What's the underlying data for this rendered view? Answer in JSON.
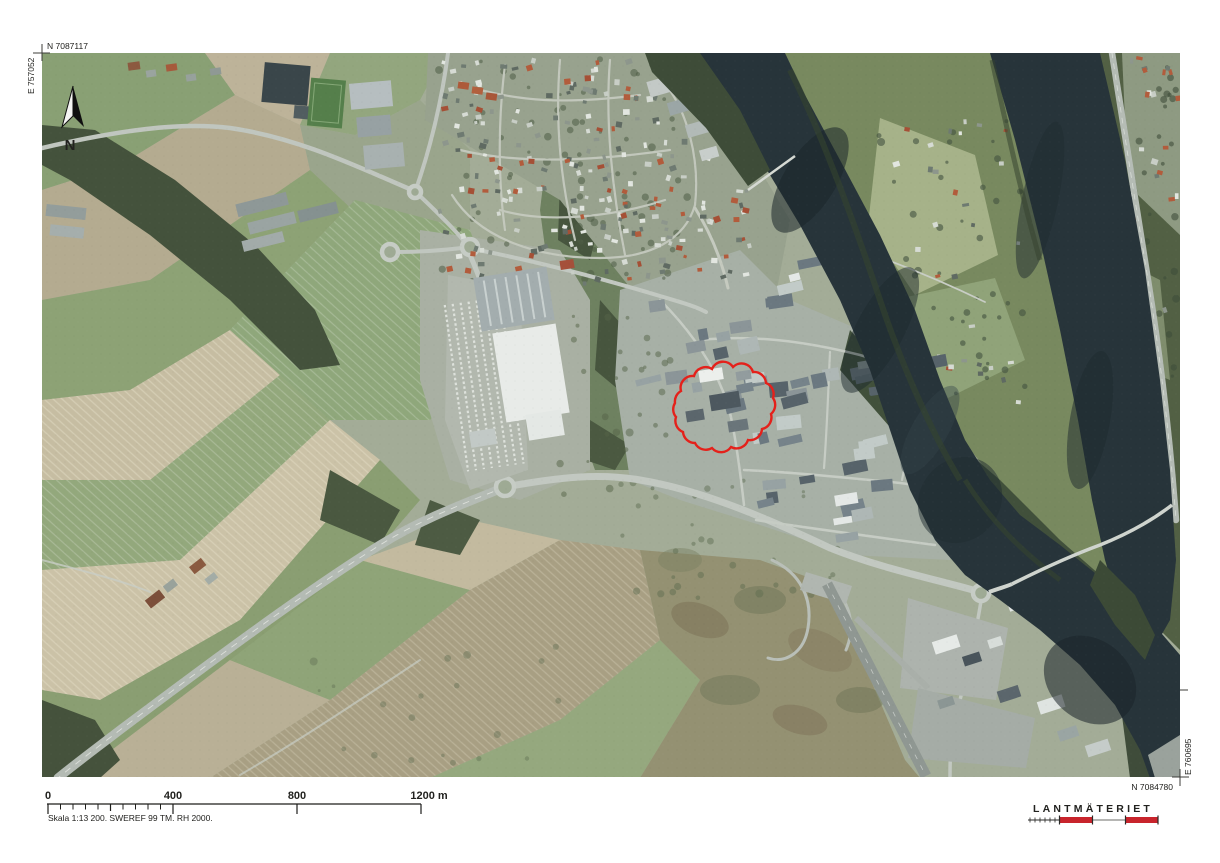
{
  "map_sheet": {
    "coordinates": {
      "top_left_northing": "N 7087117",
      "left_easting": "E 757052",
      "right_easting": "E 760695",
      "bottom_right_northing": "N 7084780"
    },
    "north_arrow_label": "N",
    "scale_bar": {
      "tick_labels": [
        "0",
        "400",
        "800",
        "1200 m"
      ],
      "caption": "Skala 1:13 200. SWEREF 99 TM. RH 2000."
    },
    "publisher": {
      "name": "LANTMÄTERIET",
      "brand_red": "#c8242c"
    },
    "annotation": {
      "type": "revision-cloud",
      "color": "#e4211b"
    }
  }
}
